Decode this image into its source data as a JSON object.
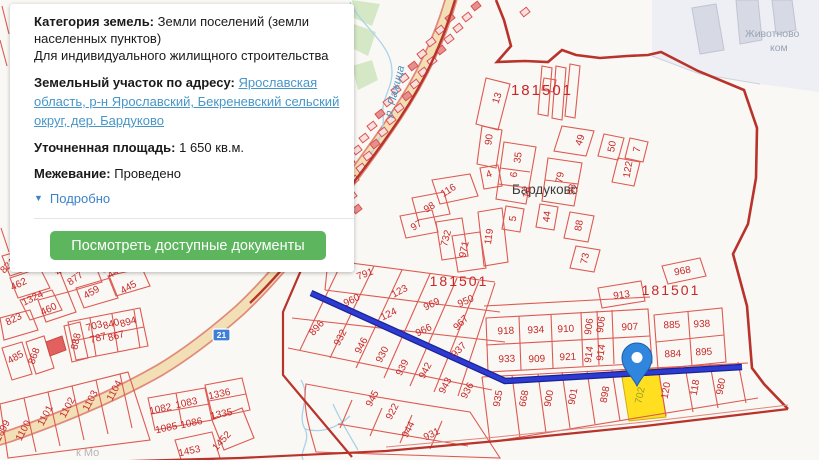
{
  "panel": {
    "category_label": "Категория земель:",
    "category_value": "Земли поселений (земли населенных пунктов)",
    "category_line2": "Для индивидуального жилищного строительства",
    "address_label": "Земельный участок по адресу:",
    "address_link": "Ярославская область, р-н Ярославский, Бекреневский сельский округ, дер. Бардуково",
    "area_label": "Уточненная площадь:",
    "area_value": "1 650 кв.м.",
    "survey_label": "Межевание:",
    "survey_value": "Проведено",
    "details_icon": "▼",
    "details_label": "Подробно",
    "button_label": "Посмотреть доступные документы"
  },
  "map": {
    "village_label": "Бардуково",
    "river_label": "р. Пажица",
    "farm_label_line1": "Животново",
    "farm_label_line2": "ком",
    "road_sign_label": "21",
    "watermark": "к Мо",
    "highlighted_parcel": "702",
    "quarter_labels": [
      {
        "t": "181501",
        "x": 542,
        "y": 95,
        "s": 15
      },
      {
        "t": "181501",
        "x": 459,
        "y": 286,
        "s": 14
      },
      {
        "t": "181501",
        "x": 671,
        "y": 295,
        "s": 14
      }
    ],
    "parcels": [
      {
        "t": "13",
        "x": 500,
        "y": 99,
        "r": -72
      },
      {
        "t": "90",
        "x": 492,
        "y": 140,
        "r": -82
      },
      {
        "t": "35",
        "x": 521,
        "y": 158,
        "r": -82
      },
      {
        "t": "6",
        "x": 517,
        "y": 175,
        "r": -82
      },
      {
        "t": "16",
        "x": 530,
        "y": 193,
        "r": -80
      },
      {
        "t": "5",
        "x": 516,
        "y": 219,
        "r": -82
      },
      {
        "t": "44",
        "x": 550,
        "y": 217,
        "r": -82
      },
      {
        "t": "79",
        "x": 563,
        "y": 178,
        "r": -80
      },
      {
        "t": "98",
        "x": 575,
        "y": 190,
        "r": -80
      },
      {
        "t": "88",
        "x": 582,
        "y": 226,
        "r": -80
      },
      {
        "t": "73",
        "x": 588,
        "y": 259,
        "r": -78
      },
      {
        "t": "49",
        "x": 583,
        "y": 141,
        "r": -72
      },
      {
        "t": "50",
        "x": 615,
        "y": 147,
        "r": -80
      },
      {
        "t": "7",
        "x": 640,
        "y": 150,
        "r": -80
      },
      {
        "t": "122",
        "x": 631,
        "y": 170,
        "r": -80
      },
      {
        "t": "4",
        "x": 490,
        "y": 177,
        "r": -20
      },
      {
        "t": "116",
        "x": 450,
        "y": 193,
        "r": -32
      },
      {
        "t": "98",
        "x": 431,
        "y": 210,
        "r": -32
      },
      {
        "t": "97",
        "x": 418,
        "y": 228,
        "r": -32
      },
      {
        "t": "732",
        "x": 449,
        "y": 239,
        "r": -75
      },
      {
        "t": "971",
        "x": 467,
        "y": 250,
        "r": -78
      },
      {
        "t": "119",
        "x": 492,
        "y": 237,
        "r": -82
      },
      {
        "t": "791",
        "x": 366,
        "y": 277,
        "r": -20
      },
      {
        "t": "123",
        "x": 401,
        "y": 294,
        "r": -28
      },
      {
        "t": "960",
        "x": 353,
        "y": 303,
        "r": -26
      },
      {
        "t": "124",
        "x": 390,
        "y": 317,
        "r": -26
      },
      {
        "t": "969",
        "x": 433,
        "y": 307,
        "r": -26
      },
      {
        "t": "966",
        "x": 425,
        "y": 333,
        "r": -26
      },
      {
        "t": "950",
        "x": 467,
        "y": 304,
        "r": -24
      },
      {
        "t": "967",
        "x": 463,
        "y": 325,
        "r": -45
      },
      {
        "t": "937",
        "x": 461,
        "y": 352,
        "r": -45
      },
      {
        "t": "896",
        "x": 319,
        "y": 330,
        "r": -48
      },
      {
        "t": "932",
        "x": 343,
        "y": 339,
        "r": -62
      },
      {
        "t": "946",
        "x": 364,
        "y": 347,
        "r": -62
      },
      {
        "t": "930",
        "x": 385,
        "y": 356,
        "r": -62
      },
      {
        "t": "939",
        "x": 405,
        "y": 369,
        "r": -62
      },
      {
        "t": "942",
        "x": 428,
        "y": 372,
        "r": -62
      },
      {
        "t": "943",
        "x": 448,
        "y": 387,
        "r": -62
      },
      {
        "t": "936",
        "x": 470,
        "y": 392,
        "r": -62
      },
      {
        "t": "945",
        "x": 375,
        "y": 400,
        "r": -62
      },
      {
        "t": "922",
        "x": 395,
        "y": 413,
        "r": -62
      },
      {
        "t": "944",
        "x": 411,
        "y": 431,
        "r": -62
      },
      {
        "t": "931",
        "x": 433,
        "y": 437,
        "r": -26
      },
      {
        "t": "918",
        "x": 506,
        "y": 334,
        "r": -3
      },
      {
        "t": "934",
        "x": 536,
        "y": 333,
        "r": -3
      },
      {
        "t": "910",
        "x": 566,
        "y": 332,
        "r": -3
      },
      {
        "t": "906",
        "x": 592,
        "y": 327,
        "r": -82
      },
      {
        "t": "906",
        "x": 604,
        "y": 325,
        "r": -82
      },
      {
        "t": "907",
        "x": 630,
        "y": 330,
        "r": -3
      },
      {
        "t": "933",
        "x": 507,
        "y": 362,
        "r": -3
      },
      {
        "t": "909",
        "x": 537,
        "y": 362,
        "r": -3
      },
      {
        "t": "921",
        "x": 568,
        "y": 360,
        "r": -3
      },
      {
        "t": "914",
        "x": 592,
        "y": 355,
        "r": -82
      },
      {
        "t": "914",
        "x": 604,
        "y": 353,
        "r": -82
      },
      {
        "t": "913",
        "x": 622,
        "y": 298,
        "r": -8
      },
      {
        "t": "968",
        "x": 683,
        "y": 274,
        "r": -10
      },
      {
        "t": "885",
        "x": 672,
        "y": 328,
        "r": -3
      },
      {
        "t": "938",
        "x": 702,
        "y": 327,
        "r": -3
      },
      {
        "t": "884",
        "x": 673,
        "y": 357,
        "r": -3
      },
      {
        "t": "895",
        "x": 704,
        "y": 355,
        "r": -3
      },
      {
        "t": "935",
        "x": 501,
        "y": 399,
        "r": -80
      },
      {
        "t": "668",
        "x": 527,
        "y": 399,
        "r": -80
      },
      {
        "t": "900",
        "x": 552,
        "y": 399,
        "r": -80
      },
      {
        "t": "901",
        "x": 576,
        "y": 397,
        "r": -80
      },
      {
        "t": "898",
        "x": 608,
        "y": 395,
        "r": -80
      },
      {
        "t": "702",
        "x": 643,
        "y": 396,
        "r": -78,
        "c": "olive"
      },
      {
        "t": "120",
        "x": 669,
        "y": 391,
        "r": -80
      },
      {
        "t": "118",
        "x": 698,
        "y": 388,
        "r": -80
      },
      {
        "t": "980",
        "x": 724,
        "y": 387,
        "r": -80
      },
      {
        "t": "821",
        "x": 10,
        "y": 268,
        "r": -45
      },
      {
        "t": "462",
        "x": 20,
        "y": 287,
        "r": -26
      },
      {
        "t": "1324",
        "x": 34,
        "y": 301,
        "r": -26
      },
      {
        "t": "823",
        "x": 15,
        "y": 322,
        "r": -26
      },
      {
        "t": "460",
        "x": 50,
        "y": 312,
        "r": -26
      },
      {
        "t": "451",
        "x": 65,
        "y": 271,
        "r": -35
      },
      {
        "t": "877",
        "x": 77,
        "y": 281,
        "r": -35
      },
      {
        "t": "459",
        "x": 93,
        "y": 295,
        "r": -30
      },
      {
        "t": "446",
        "x": 117,
        "y": 274,
        "r": -35
      },
      {
        "t": "445",
        "x": 130,
        "y": 290,
        "r": -30
      },
      {
        "t": "703",
        "x": 95,
        "y": 329,
        "r": -16
      },
      {
        "t": "840",
        "x": 112,
        "y": 327,
        "r": -16
      },
      {
        "t": "894",
        "x": 129,
        "y": 325,
        "r": -16
      },
      {
        "t": "787",
        "x": 99,
        "y": 341,
        "r": -16
      },
      {
        "t": "867",
        "x": 117,
        "y": 339,
        "r": -16
      },
      {
        "t": "888",
        "x": 79,
        "y": 342,
        "r": -78
      },
      {
        "t": "868",
        "x": 37,
        "y": 357,
        "r": -70
      },
      {
        "t": "485",
        "x": 17,
        "y": 360,
        "r": -30
      },
      {
        "t": "1099",
        "x": 5,
        "y": 432,
        "r": -62
      },
      {
        "t": "1100",
        "x": 26,
        "y": 432,
        "r": -62
      },
      {
        "t": "1101",
        "x": 48,
        "y": 417,
        "r": -62
      },
      {
        "t": "1102",
        "x": 70,
        "y": 409,
        "r": -62
      },
      {
        "t": "1103",
        "x": 93,
        "y": 402,
        "r": -62
      },
      {
        "t": "1104",
        "x": 117,
        "y": 392,
        "r": -62
      },
      {
        "t": "1082",
        "x": 161,
        "y": 412,
        "r": -12
      },
      {
        "t": "1083",
        "x": 187,
        "y": 406,
        "r": -12
      },
      {
        "t": "1085",
        "x": 167,
        "y": 431,
        "r": -12
      },
      {
        "t": "1086",
        "x": 192,
        "y": 426,
        "r": -12
      },
      {
        "t": "1336",
        "x": 220,
        "y": 397,
        "r": -12
      },
      {
        "t": "1335",
        "x": 222,
        "y": 417,
        "r": -12
      },
      {
        "t": "1452",
        "x": 224,
        "y": 443,
        "r": -48
      },
      {
        "t": "1453",
        "x": 190,
        "y": 454,
        "r": -12
      }
    ],
    "colors": {
      "parcel_line": "#dd5a52",
      "parcel_text": "#c62828",
      "boundary": "#b8332b",
      "route_blue": "#2a35c4",
      "marker_blue": "#2f86dc",
      "highlight_yellow": "#ffdf1f",
      "road_fill": "#f3dfb5",
      "river_blue": "#a9d3e8",
      "green_area": "#d5e8c6",
      "button_green": "#5db55d",
      "link_blue": "#4796c8"
    }
  }
}
